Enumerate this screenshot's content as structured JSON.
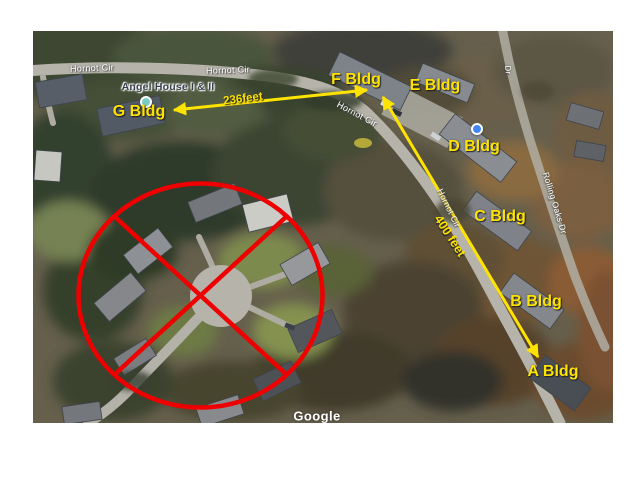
{
  "map_figure": {
    "watermark": "Google",
    "place_label": "Angel House I & II",
    "street_labels": [
      {
        "text": "Hornot Cir"
      },
      {
        "text": "Hornot Cir"
      },
      {
        "text": "Hornot Cir"
      },
      {
        "text": "Hornot Cir"
      },
      {
        "text": "Rolling Oaks Dr"
      },
      {
        "text": "Dr"
      }
    ],
    "building_labels": [
      {
        "text": "G Bldg"
      },
      {
        "text": "F Bldg"
      },
      {
        "text": "E Bldg"
      },
      {
        "text": "D Bldg"
      },
      {
        "text": "C Bldg"
      },
      {
        "text": "B Bldg"
      },
      {
        "text": "A Bldg"
      }
    ],
    "distance_labels": [
      {
        "text": "236feet"
      },
      {
        "text": "400 feet"
      }
    ],
    "markers": [
      {
        "name": "blue-location-dot",
        "color": "#4285f4"
      },
      {
        "name": "teal-poi-dot",
        "color": "#79cec4"
      }
    ],
    "annotation_colors": {
      "highlight_yellow": "#ffe300",
      "prohibition_red": "#ee0000"
    }
  }
}
